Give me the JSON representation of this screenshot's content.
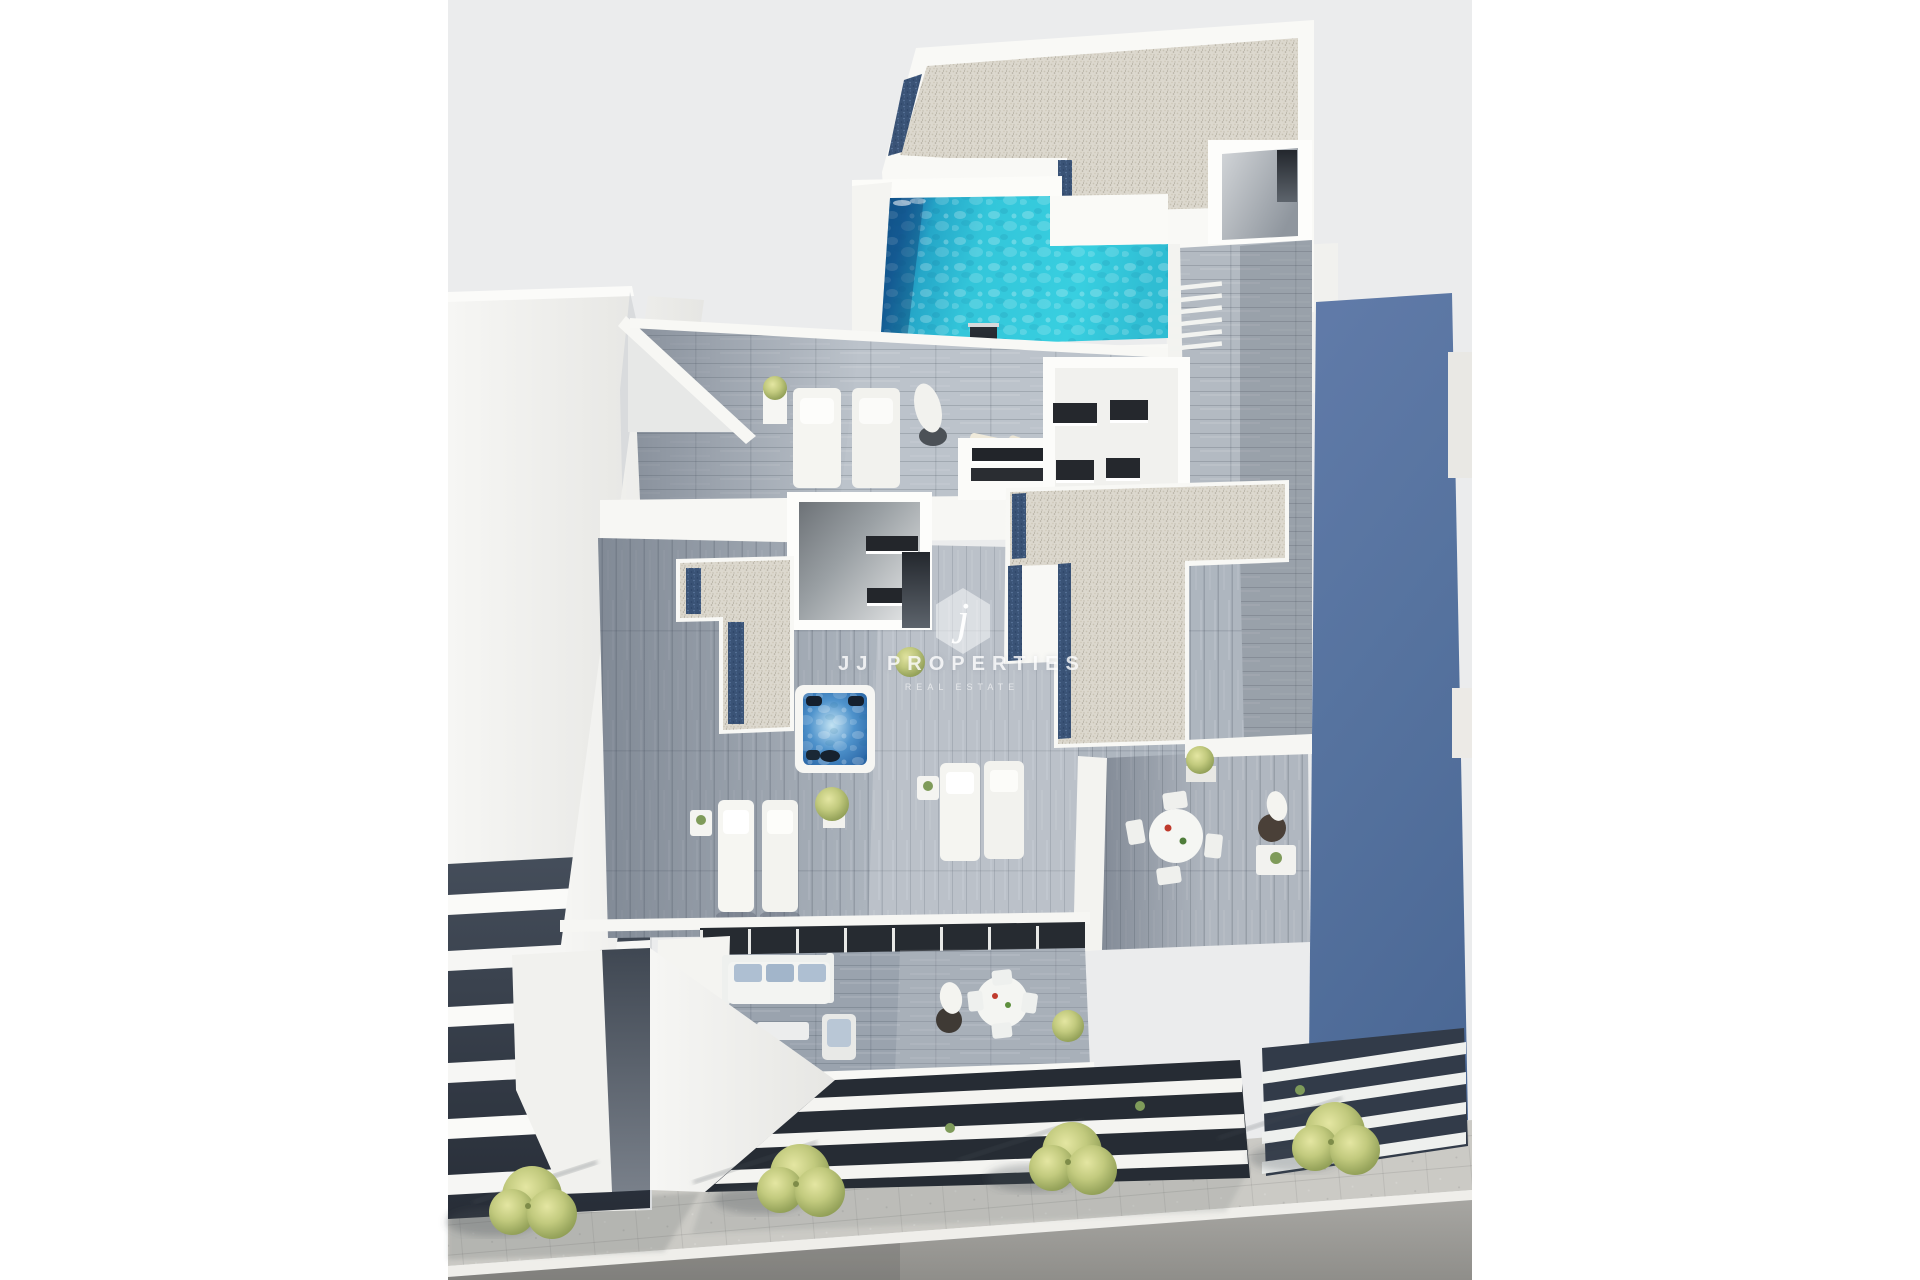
{
  "image": {
    "kind": "3d-architectural-render",
    "description": "Aerial 3D render of a modern apartment building with rooftop swimming pool, gravel roofs, wooden deck terraces with sun loungers, jacuzzi, dining sets, neighbouring buildings and street with bushes"
  },
  "watermark": {
    "monogram": "j",
    "title": "JJ PROPERTIES",
    "subtitle": "REAL ESTATE"
  },
  "colors": {
    "canvas_background": "#ebeced",
    "page_background": "#ffffff",
    "pool_turquoise": "#36cadd",
    "pool_deep_blue": "#155a97",
    "jacuzzi_blue": "#3f86c4",
    "neighbor_building_blue": "#56739f",
    "gravel_roof": "#ddd9cf",
    "gravel_navy_strip": "#3c5578",
    "wood_deck": "#b9c0c8",
    "white_wall": "#f7f7f4",
    "dark_louvre": "#262c34",
    "sidewalk": "#cbcac5",
    "road": "#9b9b97",
    "bush_green": "#b9c27b"
  }
}
